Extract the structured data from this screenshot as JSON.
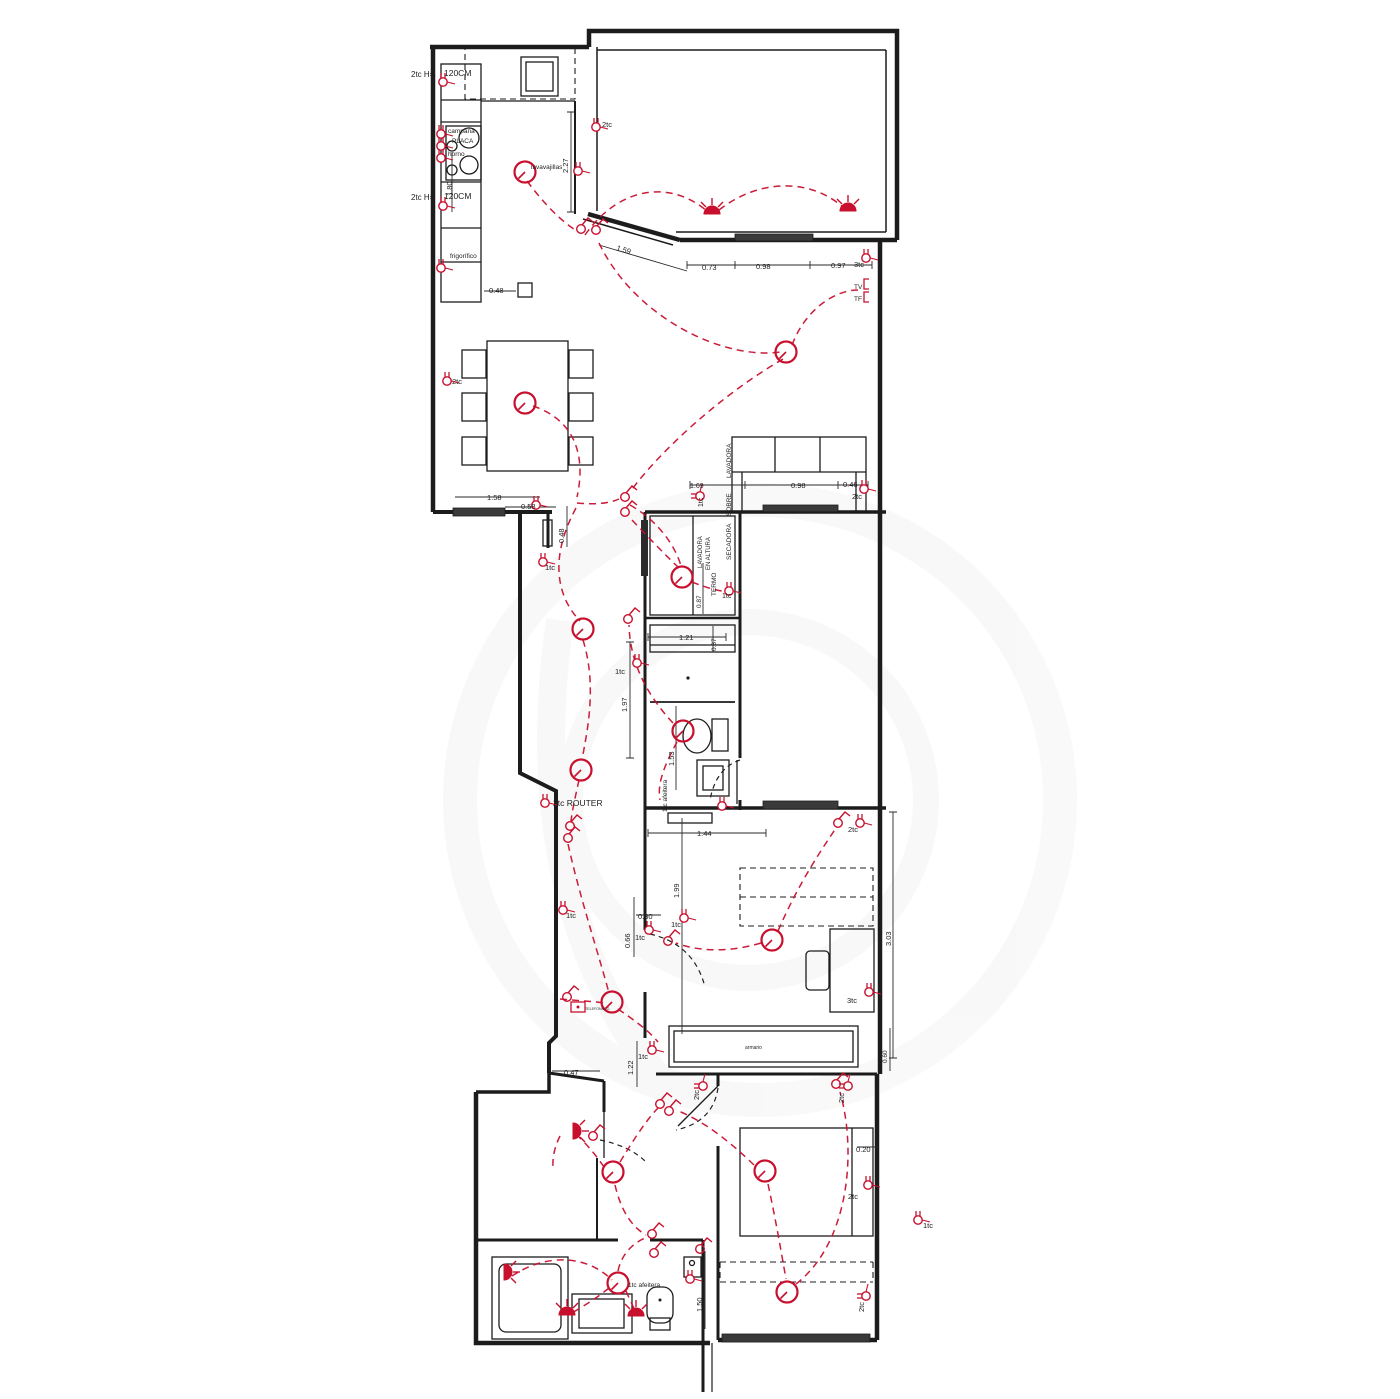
{
  "colors": {
    "wall": "#1c1c1c",
    "electric": "#c8102e",
    "background": "#ffffff",
    "watermark": "#8a8a8a"
  },
  "plan": {
    "type": "electrical-floorplan"
  },
  "labels": [
    {
      "n": "socket-note-top",
      "t": "2tc H=",
      "x": 411,
      "y": 77,
      "s": 8
    },
    {
      "n": "counter-height-top",
      "t": "120CM",
      "x": 444,
      "y": 76,
      "s": 8.5
    },
    {
      "n": "hood-label",
      "t": "campana",
      "x": 448,
      "y": 133,
      "s": 6.5
    },
    {
      "n": "hob-label",
      "t": "PLACA",
      "x": 452,
      "y": 143,
      "s": 6.5
    },
    {
      "n": "oven-label",
      "t": "horno",
      "x": 448,
      "y": 156,
      "s": 6.5
    },
    {
      "n": "dim-180",
      "t": "1.80",
      "x": 452,
      "y": 196,
      "r": -90,
      "s": 7.5
    },
    {
      "n": "socket-note-mid",
      "t": "2tc H=",
      "x": 411,
      "y": 200,
      "s": 8
    },
    {
      "n": "counter-height-mid",
      "t": "120CM",
      "x": 444,
      "y": 199,
      "s": 8.5
    },
    {
      "n": "fridge-label",
      "t": "frigorífico",
      "x": 450,
      "y": 258,
      "s": 6.5
    },
    {
      "n": "dim-048-kitchen",
      "t": "0.48",
      "x": 489,
      "y": 293,
      "s": 7.5
    },
    {
      "n": "dishwasher-label",
      "t": "lavavajillas",
      "x": 531,
      "y": 169,
      "s": 6.5
    },
    {
      "n": "dim-227",
      "t": "2.27",
      "x": 568,
      "y": 173,
      "r": -90,
      "s": 7.5
    },
    {
      "n": "socket-2tc-terrace",
      "t": "2tc",
      "x": 602,
      "y": 127,
      "c": "r",
      "s": 7.5
    },
    {
      "n": "dim-159",
      "t": "1.59",
      "x": 616,
      "y": 250,
      "r": 17,
      "s": 7.5
    },
    {
      "n": "dim-073",
      "t": "0.73",
      "x": 702,
      "y": 270,
      "s": 7.5
    },
    {
      "n": "dim-098-top",
      "t": "0.98",
      "x": 756,
      "y": 269,
      "s": 7.5
    },
    {
      "n": "dim-097",
      "t": "0.97",
      "x": 831,
      "y": 268,
      "s": 7.5
    },
    {
      "n": "socket-3tc-living",
      "t": "3tc",
      "x": 854,
      "y": 267,
      "c": "r",
      "s": 7.5
    },
    {
      "n": "tv-point",
      "t": "TV",
      "x": 854,
      "y": 289,
      "c": "r",
      "s": 6.5
    },
    {
      "n": "tf-point",
      "t": "TF",
      "x": 854,
      "y": 301,
      "c": "r",
      "s": 6.5
    },
    {
      "n": "socket-2tc-dining",
      "t": "2tc",
      "x": 452,
      "y": 384,
      "c": "r",
      "s": 7.5
    },
    {
      "n": "dim-158",
      "t": "1.58",
      "x": 487,
      "y": 500,
      "s": 7.5
    },
    {
      "n": "dim-058",
      "t": "0.58",
      "x": 521,
      "y": 509,
      "s": 7.5
    },
    {
      "n": "dim-048-v",
      "t": "0.48",
      "x": 564,
      "y": 543,
      "r": -90,
      "s": 7.5
    },
    {
      "n": "socket-1tc-hall-top",
      "t": "1tc",
      "x": 545,
      "y": 570,
      "c": "r",
      "s": 7.5
    },
    {
      "n": "dim-169",
      "t": "1.69",
      "x": 690,
      "y": 488,
      "s": 7
    },
    {
      "n": "socket-1tc-laundry",
      "t": "1tc",
      "x": 703,
      "y": 507,
      "c": "r",
      "r": -90,
      "s": 7
    },
    {
      "n": "dim-098-sofa",
      "t": "0.98",
      "x": 791,
      "y": 488,
      "s": 7.5
    },
    {
      "n": "dim-046",
      "t": "0.46",
      "x": 843,
      "y": 487,
      "s": 7.5
    },
    {
      "n": "socket-2tc-sofa",
      "t": "2tc",
      "x": 852,
      "y": 499,
      "c": "r",
      "s": 7.5
    },
    {
      "n": "laundry-note-1a",
      "t": "LAVADORA",
      "x": 731,
      "y": 478,
      "r": -90,
      "s": 6.5
    },
    {
      "n": "laundry-note-1b",
      "t": "SOBRE",
      "x": 731,
      "y": 516,
      "r": -90,
      "s": 6.5
    },
    {
      "n": "laundry-note-1c",
      "t": "SECADORA",
      "x": 731,
      "y": 560,
      "r": -90,
      "s": 6.5
    },
    {
      "n": "laundry-note-2a",
      "t": "LAVADORA",
      "x": 702,
      "y": 568,
      "r": -90,
      "s": 6
    },
    {
      "n": "laundry-note-2b",
      "t": "EN ALTURA",
      "x": 710,
      "y": 570,
      "r": -90,
      "s": 6
    },
    {
      "n": "boiler-note",
      "t": "TERMO",
      "x": 716,
      "y": 596,
      "r": -90,
      "s": 6.5
    },
    {
      "n": "dim-087",
      "t": "0.87",
      "x": 701,
      "y": 608,
      "r": -90,
      "s": 6.5
    },
    {
      "n": "socket-1tc-termo",
      "t": "1tc",
      "x": 722,
      "y": 598,
      "c": "r",
      "s": 7
    },
    {
      "n": "dim-121",
      "t": "1.21",
      "x": 679,
      "y": 640,
      "s": 7.5
    },
    {
      "n": "dim-037",
      "t": "0.37",
      "x": 716,
      "y": 651,
      "r": -90,
      "s": 6.5
    },
    {
      "n": "socket-1tc-bath1",
      "t": "1tc",
      "x": 615,
      "y": 674,
      "c": "r",
      "s": 7.5
    },
    {
      "n": "dim-197",
      "t": "1.97",
      "x": 627,
      "y": 712,
      "r": -90,
      "s": 7.5
    },
    {
      "n": "dim-153",
      "t": "1.53",
      "x": 674,
      "y": 766,
      "r": -90,
      "s": 7.5
    },
    {
      "n": "shaver-socket-bath1",
      "t": "1tc afeitera",
      "x": 667,
      "y": 812,
      "r": -90,
      "c": "r",
      "s": 6.5
    },
    {
      "n": "dim-144",
      "t": "1.44",
      "x": 697,
      "y": 836,
      "s": 7.5
    },
    {
      "n": "socket-2tc-bed1",
      "t": "2tc",
      "x": 848,
      "y": 832,
      "c": "r",
      "s": 7.5
    },
    {
      "n": "router-note",
      "t": "2tc  ROUTER",
      "x": 553,
      "y": 806,
      "s": 8.5
    },
    {
      "n": "socket-1tc-corridor",
      "t": "1tc",
      "x": 566,
      "y": 918,
      "c": "r",
      "s": 7.5
    },
    {
      "n": "dim-030",
      "t": "0.30",
      "x": 638,
      "y": 919,
      "s": 7.5
    },
    {
      "n": "socket-1tc-bed1-a",
      "t": "1tc",
      "x": 671,
      "y": 927,
      "c": "r",
      "s": 7.5
    },
    {
      "n": "dim-066",
      "t": "0.66",
      "x": 630,
      "y": 948,
      "r": -90,
      "s": 7.5
    },
    {
      "n": "socket-1tc-bed1-b",
      "t": "1tc",
      "x": 635,
      "y": 940,
      "c": "r",
      "s": 7.5
    },
    {
      "n": "dim-199",
      "t": "1.99",
      "x": 679,
      "y": 898,
      "r": -90,
      "s": 7.5
    },
    {
      "n": "dim-303",
      "t": "3.03",
      "x": 891,
      "y": 946,
      "r": -90,
      "s": 7.5
    },
    {
      "n": "socket-3tc-desk",
      "t": "3tc",
      "x": 847,
      "y": 1003,
      "c": "r",
      "s": 7.5
    },
    {
      "n": "dim-060",
      "t": "0.60",
      "x": 887,
      "y": 1063,
      "r": -90,
      "s": 6.5
    },
    {
      "n": "dim-122",
      "t": "1.22",
      "x": 633,
      "y": 1075,
      "r": -90,
      "s": 7.5
    },
    {
      "n": "socket-1tc-hall2",
      "t": "1tc",
      "x": 638,
      "y": 1059,
      "c": "r",
      "s": 7.5
    },
    {
      "n": "dim-047",
      "t": "0.47",
      "x": 564,
      "y": 1075,
      "s": 7.5
    },
    {
      "n": "socket-2tc-bed2-a",
      "t": "2tc",
      "x": 699,
      "y": 1100,
      "r": -90,
      "c": "r",
      "s": 7.5
    },
    {
      "n": "socket-2tc-bed2-b",
      "t": "2tc",
      "x": 844,
      "y": 1103,
      "r": -90,
      "c": "r",
      "s": 7.5
    },
    {
      "n": "dim-020",
      "t": "0.20",
      "x": 856,
      "y": 1152,
      "s": 7.5
    },
    {
      "n": "socket-2tc-bed2-c",
      "t": "2tc",
      "x": 848,
      "y": 1199,
      "c": "r",
      "s": 7.5
    },
    {
      "n": "socket-1tc-ext",
      "t": "1tc",
      "x": 923,
      "y": 1228,
      "c": "r",
      "s": 7.5
    },
    {
      "n": "socket-2tc-bed2-d",
      "t": "2tc",
      "x": 864,
      "y": 1312,
      "r": -90,
      "c": "r",
      "s": 7.5
    },
    {
      "n": "shaver-socket-bath2",
      "t": "1tc afeitera",
      "x": 628,
      "y": 1287,
      "s": 6.5
    },
    {
      "n": "dim-150",
      "t": "1.50",
      "x": 702,
      "y": 1312,
      "r": -90,
      "s": 7.5
    },
    {
      "n": "intercom-label",
      "t": "TELEFONILLO",
      "x": 585,
      "y": 1010,
      "c": "r",
      "s": 3.6
    },
    {
      "n": "wardrobe-label",
      "t": "armario",
      "x": 745,
      "y": 1049,
      "s": 5
    }
  ],
  "symbols": {
    "sockets": [
      [
        443,
        82
      ],
      [
        441,
        134
      ],
      [
        441,
        146
      ],
      [
        441,
        158
      ],
      [
        443,
        206
      ],
      [
        441,
        268
      ],
      [
        578,
        171
      ],
      [
        596,
        127
      ],
      [
        866,
        258
      ],
      [
        447,
        381
      ],
      [
        536,
        505
      ],
      [
        543,
        562
      ],
      [
        700,
        496,
        -90
      ],
      [
        864,
        489
      ],
      [
        729,
        591
      ],
      [
        637,
        663
      ],
      [
        722,
        806
      ],
      [
        860,
        823
      ],
      [
        545,
        803
      ],
      [
        563,
        910
      ],
      [
        684,
        918
      ],
      [
        649,
        930
      ],
      [
        869,
        992
      ],
      [
        652,
        1050
      ],
      [
        703,
        1086,
        -90
      ],
      [
        848,
        1086,
        -90
      ],
      [
        868,
        1185
      ],
      [
        918,
        1220
      ],
      [
        866,
        1296,
        -90
      ],
      [
        690,
        1279
      ]
    ],
    "ceiling_lights": [
      [
        525,
        172
      ],
      [
        525,
        403
      ],
      [
        786,
        352
      ],
      [
        682,
        577
      ],
      [
        583,
        629
      ],
      [
        581,
        770
      ],
      [
        683,
        731
      ],
      [
        612,
        1002
      ],
      [
        772,
        940
      ],
      [
        613,
        1172
      ],
      [
        765,
        1171
      ],
      [
        787,
        1292
      ],
      [
        618,
        1283
      ]
    ],
    "wall_lights": [
      [
        712,
        212,
        0
      ],
      [
        848,
        209,
        0
      ],
      [
        567,
        1313,
        0
      ],
      [
        636,
        1314,
        0
      ],
      [
        506,
        1272,
        90
      ],
      [
        575,
        1131,
        90
      ]
    ],
    "switches": [
      [
        581,
        229
      ],
      [
        596,
        230
      ],
      [
        625,
        497
      ],
      [
        625,
        512
      ],
      [
        628,
        619
      ],
      [
        570,
        826
      ],
      [
        568,
        838
      ],
      [
        567,
        997
      ],
      [
        838,
        823
      ],
      [
        668,
        941
      ],
      [
        660,
        1104
      ],
      [
        669,
        1111
      ],
      [
        593,
        1136
      ],
      [
        836,
        1084
      ],
      [
        652,
        1234
      ],
      [
        654,
        1253
      ],
      [
        700,
        1249
      ]
    ],
    "tv_points": [
      [
        864,
        284
      ],
      [
        864,
        297
      ]
    ],
    "telefonillo": [
      578,
      1007
    ]
  }
}
